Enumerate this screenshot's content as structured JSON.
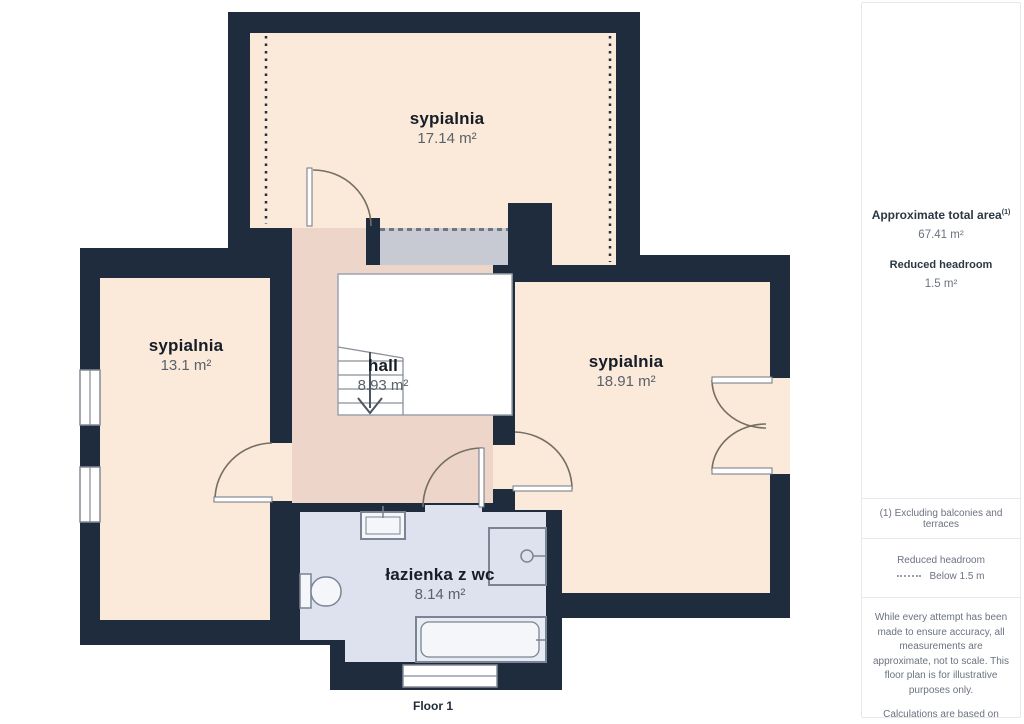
{
  "plan": {
    "floor_label": "Floor 1",
    "rooms": [
      {
        "name": "sypialnia",
        "area": "17.14 m²"
      },
      {
        "name": "sypialnia",
        "area": "13.1 m²"
      },
      {
        "name": "sypialnia",
        "area": "18.91 m²"
      },
      {
        "name": "hall",
        "area": "8.93 m²"
      },
      {
        "name": "łazienka z wc",
        "area": "8.14 m²"
      }
    ],
    "colors": {
      "wall": "#1e2c3d",
      "bedroom_floor": "#fbeada",
      "hall_floor": "#edd6c9",
      "bathroom_floor": "#dee2ee",
      "reduced_headroom_block": "#c7cad2",
      "stairwell": "#ffffff"
    }
  },
  "sidebar": {
    "total_area_label": "Approximate total area",
    "total_area_footnote_marker": "(1)",
    "total_area_value": "67.41 m²",
    "reduced_headroom_label": "Reduced headroom",
    "reduced_headroom_value": "1.5 m²",
    "footnote": "(1) Excluding balconies and terraces",
    "legend_title": "Reduced headroom",
    "legend_item": "Below 1.5 m",
    "disclaimer_1": "While every attempt has been made to ensure accuracy, all measurements are approximate, not to scale. This floor plan is for illustrative purposes only.",
    "disclaimer_2": "Calculations are based on RICS IPMS 3C standard.",
    "brand_name": "GIRAFFE",
    "brand_suffix": "360"
  }
}
